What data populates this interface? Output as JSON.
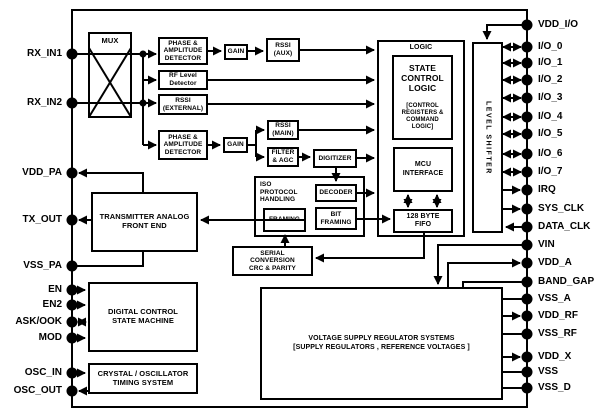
{
  "diagram": {
    "kind": "IC functional block diagram",
    "colors": {
      "line": "#000000",
      "background": "#ffffff"
    }
  },
  "blocks": {
    "mux": "MUX",
    "phase_amp_top": "PHASE &\nAMPLITUDE\nDETECTOR",
    "gain_top": "GAIN",
    "rssi_aux": "RSSI\n(AUX)",
    "rf_level": "RF Level\nDetector",
    "rssi_ext": "RSSI\n(EXTERNAL)",
    "phase_amp_bot": "PHASE &\nAMPLITUDE\nDETECTOR",
    "gain_bot": "GAIN",
    "rssi_main": "RSSI\n(MAIN)",
    "filter_agc": "FILTER\n& AGC",
    "digitizer": "DIGITIZER",
    "iso": "ISO\nPROTOCOL\nHANDLING",
    "decoder": "DECODER",
    "bit_framing": "BIT\nFRAMING",
    "framing": "FRAMING",
    "serial_conv": "SERIAL\nCONVERSION\nCRC & PARITY",
    "logic": "LOGIC",
    "state_control": "STATE\nCONTROL\nLOGIC",
    "control_regs": "[CONTROL\nREGISTERS &\nCOMMAND\nLOGIC]",
    "mcu": "MCU\nINTERFACE",
    "fifo": "128 BYTE\nFIFO",
    "level_shifter": "LEVEL SHIFTER",
    "tx_afe": "TRANSMITTER ANALOG\nFRONT END",
    "dcsm": "DIGITAL CONTROL\nSTATE MACHINE",
    "crystal": "CRYSTAL / OSCILLATOR\nTIMING SYSTEM",
    "regulator": "VOLTAGE SUPPLY REGULATOR SYSTEMS\n[SUPPLY REGULATORS , REFERENCE VOLTAGES ]"
  },
  "pins": {
    "left": [
      "RX_IN1",
      "RX_IN2",
      "VDD_PA",
      "TX_OUT",
      "VSS_PA",
      "EN",
      "EN2",
      "ASK/OOK",
      "MOD",
      "OSC_IN",
      "OSC_OUT"
    ],
    "right": [
      "VDD_I/O",
      "I/O_0",
      "I/O_1",
      "I/O_2",
      "I/O_3",
      "I/O_4",
      "I/O_5",
      "I/O_6",
      "I/O_7",
      "IRQ",
      "SYS_CLK",
      "DATA_CLK",
      "VIN",
      "VDD_A",
      "BAND_GAP",
      "VSS_A",
      "VDD_RF",
      "VSS_RF",
      "VDD_X",
      "VSS",
      "VSS_D"
    ]
  }
}
